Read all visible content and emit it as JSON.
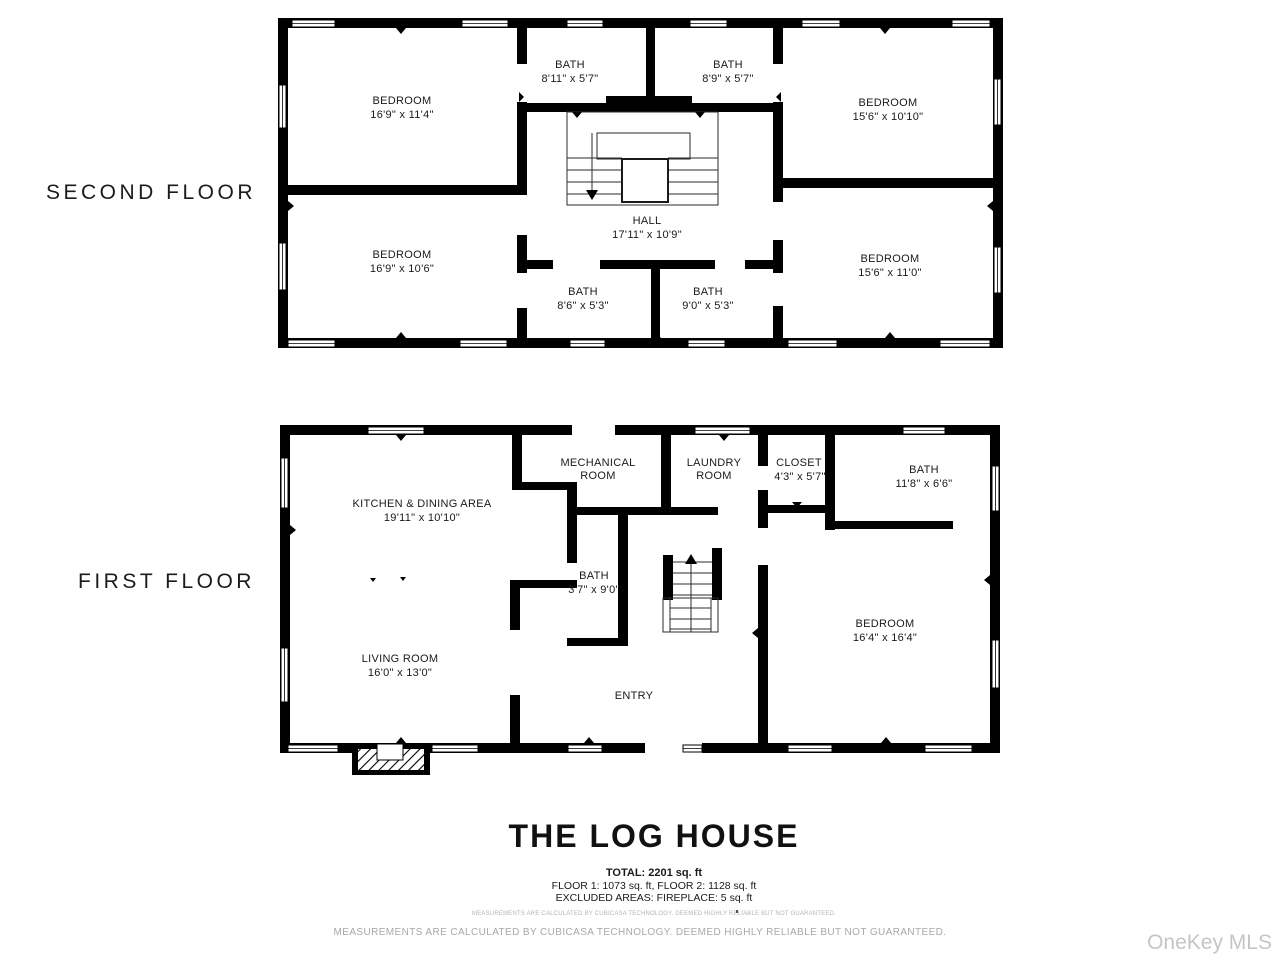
{
  "colors": {
    "wall": "#000000",
    "text": "#1a1a1a",
    "muted_gray": "#a8a8a8",
    "watermark_gray": "#c5c5c5"
  },
  "floors": [
    {
      "label": "SECOND FLOOR",
      "rooms": [
        {
          "line1": "BEDROOM",
          "line2": "16'9\" x 11'4\""
        },
        {
          "line1": "BATH",
          "line2": "8'11\" x 5'7\""
        },
        {
          "line1": "BATH",
          "line2": "8'9\" x 5'7\""
        },
        {
          "line1": "BEDROOM",
          "line2": "15'6\" x 10'10\""
        },
        {
          "line1": "HALL",
          "line2": "17'11\" x 10'9\""
        },
        {
          "line1": "BEDROOM",
          "line2": "16'9\" x 10'6\""
        },
        {
          "line1": "BATH",
          "line2": "8'6\" x 5'3\""
        },
        {
          "line1": "BATH",
          "line2": "9'0\" x 5'3\""
        },
        {
          "line1": "BEDROOM",
          "line2": "15'6\" x 11'0\""
        }
      ]
    },
    {
      "label": "FIRST FLOOR",
      "rooms": [
        {
          "line1": "KITCHEN & DINING AREA",
          "line2": "19'11\" x 10'10\""
        },
        {
          "line1": "MECHANICAL",
          "line2": "ROOM"
        },
        {
          "line1": "LAUNDRY",
          "line2": "ROOM"
        },
        {
          "line1": "CLOSET",
          "line2": "4'3\" x 5'7\""
        },
        {
          "line1": "BATH",
          "line2": "11'8\" x 6'6\""
        },
        {
          "line1": "BATH",
          "line2": "3'7\" x 9'0\""
        },
        {
          "line1": "LIVING ROOM",
          "line2": "16'0\" x 13'0\""
        },
        {
          "line1": "ENTRY",
          "line2": ""
        },
        {
          "line1": "BEDROOM",
          "line2": "16'4\" x 16'4\""
        }
      ]
    }
  ],
  "footer": {
    "title": "THE LOG HOUSE",
    "total": "TOTAL: 2201 sq. ft",
    "floors_line": "FLOOR 1: 1073 sq. ft, FLOOR 2: 1128 sq. ft",
    "excluded_line": "EXCLUDED AREAS: FIREPLACE: 5 sq. ft",
    "disclaimer_small": "MEASUREMENTS ARE CALCULATED BY CUBICASA TECHNOLOGY. DEEMED HIGHLY RELIABLE BUT NOT GUARANTEED.",
    "disclaimer": "MEASUREMENTS ARE CALCULATED BY CUBICASA TECHNOLOGY. DEEMED HIGHLY RELIABLE BUT NOT GUARANTEED.",
    "watermark": "OneKey MLS"
  }
}
